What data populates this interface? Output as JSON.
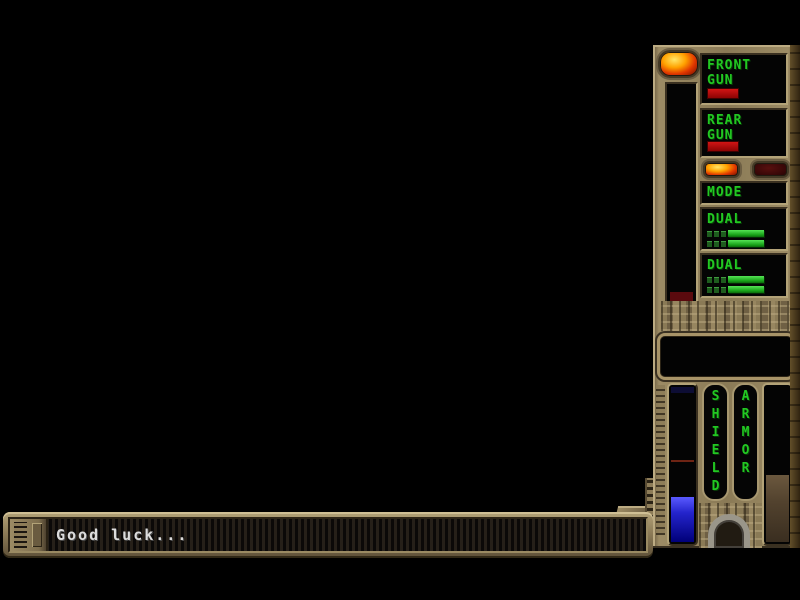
{
  "message_bar": {
    "text": "Good luck..."
  },
  "weapon_panel": {
    "front_gun": {
      "line1": "FRONT",
      "line2": "GUN"
    },
    "rear_gun": {
      "line1": "REAR",
      "line2": "GUN"
    },
    "mode_label": "MODE",
    "front_gun_mode": "DUAL",
    "rear_gun_mode": "DUAL",
    "front_power_segments": 3,
    "rear_power_segments": 3,
    "mode_led_left": "lit",
    "mode_led_right": "off"
  },
  "status_panel": {
    "shield_label": "SHIELD",
    "armor_label": "ARMOR",
    "shield_fill_pct": 28,
    "shield_marker_pct": 47,
    "armor_fill_pct": 42
  },
  "colors": {
    "panel_bronze": "#8d7c58",
    "hud_green": "#22c822",
    "alert_red": "#b00404",
    "shield_blue": "#2424cc",
    "armor_brown": "#52422e",
    "led_lit_orange": "#ffa200",
    "led_off_maroon": "#3a0808"
  }
}
